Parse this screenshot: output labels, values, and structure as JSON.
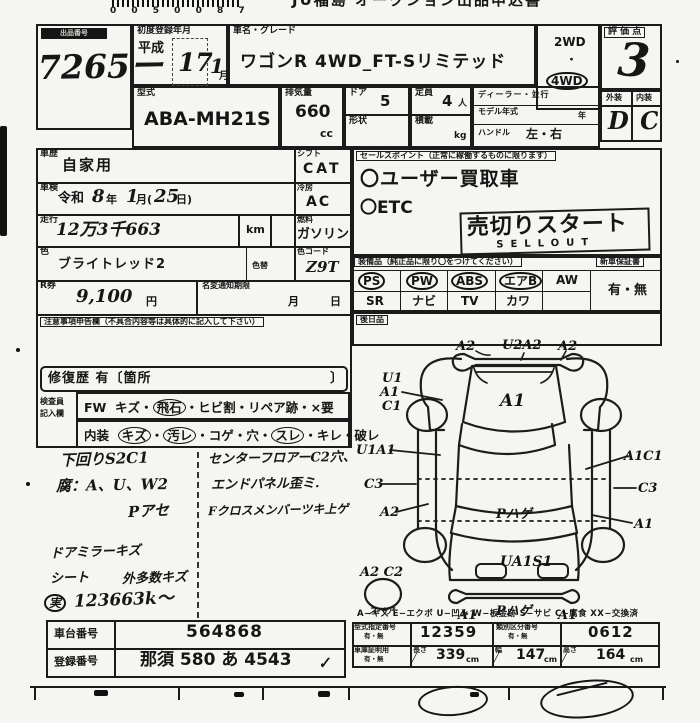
{
  "top": {
    "barcode_digits": "0 0 5 0 0 8 7",
    "title": "JU福島 オークション出品申込書"
  },
  "lot": {
    "label": "出品番号",
    "number": "7265ー"
  },
  "reg": {
    "label": "初度登録年月",
    "era": "平成",
    "year": "17",
    "month": "1",
    "month_unit": "月"
  },
  "name": {
    "label": "車名・グレード",
    "value": "ワゴンR 4WD_FT-Sリミテッド"
  },
  "drive": {
    "opt1": "2WD",
    "dot": "・",
    "opt2": "4WD"
  },
  "score": {
    "label": "評 価 点",
    "value": "3"
  },
  "grade": {
    "ext_label": "外装",
    "int_label": "内装",
    "ext": "D",
    "int": "C"
  },
  "model": {
    "label": "型式",
    "value": "ABA-MH21S"
  },
  "disp": {
    "label": "排気量",
    "value": "660",
    "unit": "cc"
  },
  "door": {
    "label": "ドア",
    "value": "5",
    "shape_label": "形状"
  },
  "cap": {
    "label": "定員",
    "value": "4",
    "unit": "人",
    "load_label": "積載",
    "load_unit": "kg"
  },
  "dealer": {
    "row1": "ディーラー・並行",
    "row2": "モデル年式",
    "row2_unit": "年",
    "row3": "ハンドル",
    "row3_val": "左・右"
  },
  "hist": {
    "label": "車歴",
    "value": "自家用",
    "shift_label": "シフト",
    "shift": "CAT"
  },
  "insp": {
    "label": "車検",
    "era": "令和",
    "year": "8",
    "year_unit": "年",
    "month": "1",
    "month_unit": "月(",
    "day": "25",
    "day_unit": "日)",
    "ac_label": "冷房",
    "ac": "AC"
  },
  "mile": {
    "label": "走行",
    "value": "12万3千663",
    "unit": "km"
  },
  "fuel": {
    "label": "燃料",
    "value": "ガソリン"
  },
  "color": {
    "label": "色",
    "value": "ブライトレッド2",
    "change_label": "色替",
    "code_label": "色コード",
    "code": "Z9T"
  },
  "ticket": {
    "label": "R券",
    "value": "9,100",
    "unit": "円",
    "rename_label": "名変通知期限",
    "month": "月",
    "day": "日"
  },
  "notes_label": "注意事項申告欄（不具合内容等は具体的に記入して下さい）",
  "repair": {
    "text": "修復歴 有〔箇所",
    "close": "〕"
  },
  "inspector": {
    "label1": "検査員",
    "label2": "記入欄",
    "dot": "・",
    "fw_label": "FW",
    "fw_items": [
      "キズ",
      "飛石",
      "ヒビ割",
      "リペア跡",
      "×要"
    ],
    "int_label": "内装",
    "int_items": [
      "キズ",
      "汚レ",
      "コゲ",
      "穴",
      "スレ",
      "キレ",
      "破レ"
    ]
  },
  "sales": {
    "label": "セールスポイント（正常に稼働するものに限ります）",
    "p1": "〇ユーザー買取車",
    "p2": "〇ETC",
    "sell_jp": "売切りスタート",
    "sell_en": "SELLOUT"
  },
  "equip": {
    "label": "装備品（純正品に限り〇をつけてください）",
    "warranty_label": "新車保証書",
    "warranty": "有・無",
    "r1": [
      "PS",
      "PW",
      "ABS",
      "エアB",
      "AW"
    ],
    "r2": [
      "SR",
      "ナビ",
      "TV",
      "カワ"
    ],
    "later": "後日品"
  },
  "hand": {
    "l1": "下回りS2C1",
    "l2": "腐：A、U、W2",
    "l3": "Pアセ",
    "l4": "ドアミラーキズ",
    "l5": "シート",
    "l6": "外多数キズ",
    "l7": "実",
    "l8": "123663k〜",
    "r1": "センターフロアーC2穴、",
    "r2": "エンドパネル歪ミ.",
    "r3": "Fクロスメンバーツキ上ゲ"
  },
  "diagram": {
    "fb_l": "A2",
    "fb_c": "U2A2",
    "fb_r": "A2",
    "hood": "A1",
    "st1": "U1",
    "st2": "A1",
    "st3": "C1",
    "ls": "U1A1",
    "lr": "C3",
    "lq": "A2",
    "rs": "A1C1",
    "rr": "C3",
    "rq": "A1",
    "roof": "Pハゲ",
    "gate": "UA1S1",
    "rb": "Pハゲ",
    "rbl": "A1",
    "rbr": "A1",
    "sp1": "A2 C2",
    "sp2": "スペア",
    "legend": "A−キズ E−エクボ U−凹み W−板金跡 S−サビ C−腐食 XX−交換済"
  },
  "ids": {
    "chassis_label": "車台番号",
    "chassis": "564868",
    "plate_label": "登録番号",
    "plate": "那須 580 あ 4543",
    "check": "✓"
  },
  "cert": {
    "type_label": "型式指定番号",
    "type_sub": "有・無",
    "type_no": "12359",
    "class_label": "類別区分番号",
    "class_sub": "有・無",
    "class_no": "0612",
    "garage_label": "車庫証明用",
    "garage_sub": "有・無",
    "len_label": "長さ",
    "len": "339",
    "wid_label": "幅",
    "wid": "147",
    "hei_label": "高さ",
    "hei": "164",
    "cm": "cm",
    "slash": "╱"
  }
}
